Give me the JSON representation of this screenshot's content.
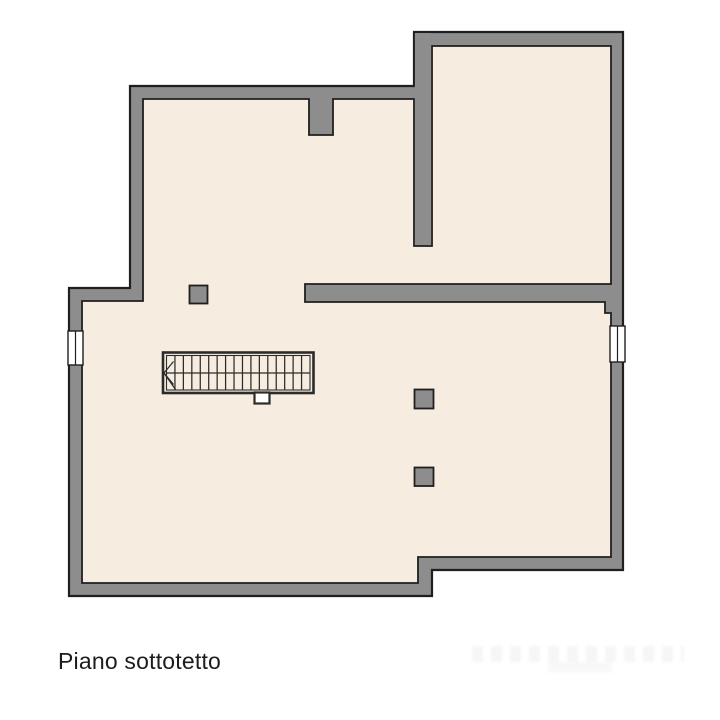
{
  "plan": {
    "label": "Piano sottotetto",
    "colors": {
      "background": "#ffffff",
      "wall_fill": "#8d8d8d",
      "wall_outline": "#1f1f1f",
      "floor_fill": "#f6ecdf",
      "stair_line": "#2b2b2b",
      "window_fill": "#ffffff",
      "label_color": "#1c1c1c"
    },
    "stairs": {
      "treads": 17,
      "direction": "left"
    }
  }
}
